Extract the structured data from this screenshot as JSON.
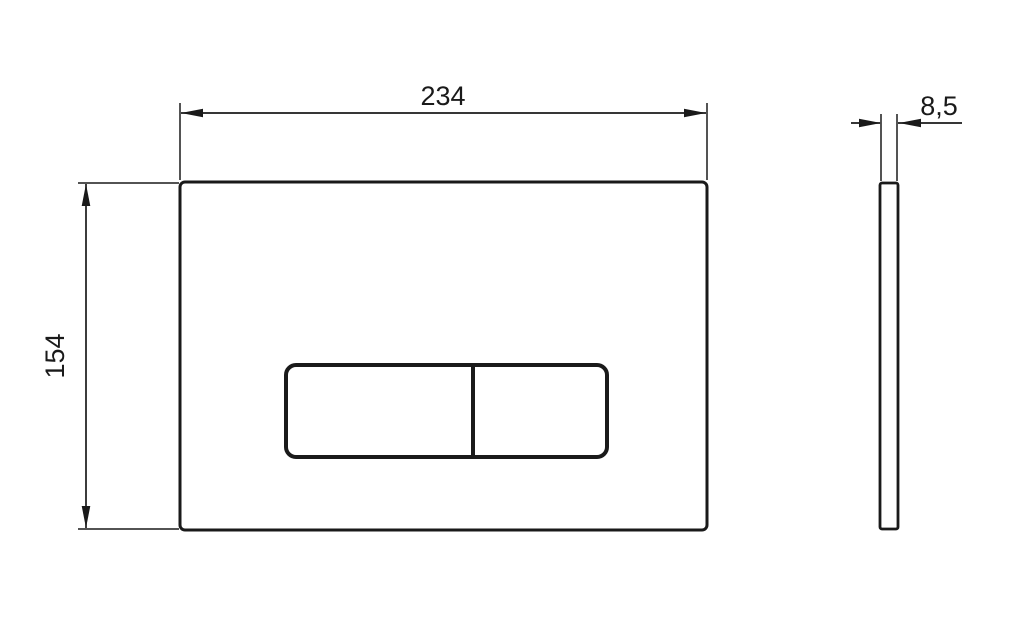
{
  "drawing": {
    "type": "dimensioned-technical-drawing",
    "dimensions": {
      "width": {
        "label": "234",
        "value": 234
      },
      "height": {
        "label": "154",
        "value": 154
      },
      "thickness": {
        "label": "8,5",
        "value": 8.5
      }
    },
    "colors": {
      "line": "#1a1a1a",
      "background": "#ffffff"
    }
  }
}
